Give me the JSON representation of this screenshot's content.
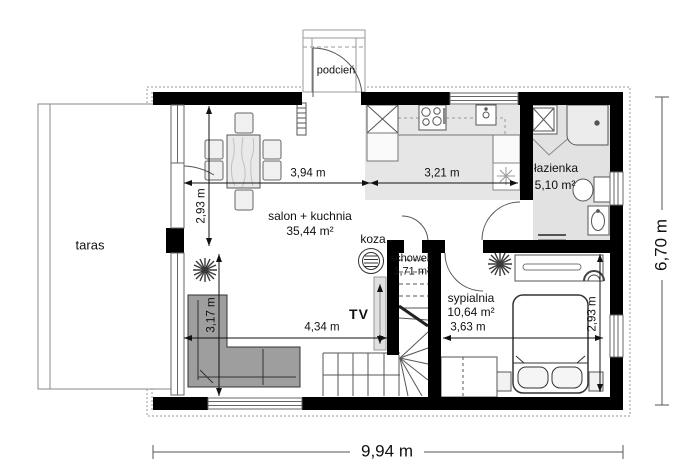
{
  "plan": {
    "rooms": {
      "living": {
        "name": "salon + kuchnia",
        "area": "35,44 m²"
      },
      "bathroom": {
        "name": "łazienka",
        "area": "5,10 m²"
      },
      "bedroom": {
        "name": "sypialnia",
        "area": "10,64 m²"
      },
      "storage": {
        "name": "schowek",
        "area": "1,71 m²"
      }
    },
    "outdoor": {
      "terrace": {
        "name": "taras"
      },
      "porch": {
        "name": "podcień"
      }
    },
    "features": {
      "tv": "TV",
      "stove": "koza"
    },
    "dims": {
      "salon_width": "3,94 m",
      "kitchen_width": "3,21 m",
      "salon_depth_upper": "2,93 m",
      "salon_depth_lower": "3,17 m",
      "salon_bottom_width": "4,34 m",
      "bedroom_width": "3,63 m",
      "bedroom_depth": "2,93 m",
      "overall_width": "9,94 m",
      "overall_depth": "6,70 m"
    },
    "colors": {
      "wall": "#000000",
      "floor_shade": "#e6e6e6",
      "sofa": "#9e9e9e",
      "dimension_line": "#222222"
    }
  }
}
